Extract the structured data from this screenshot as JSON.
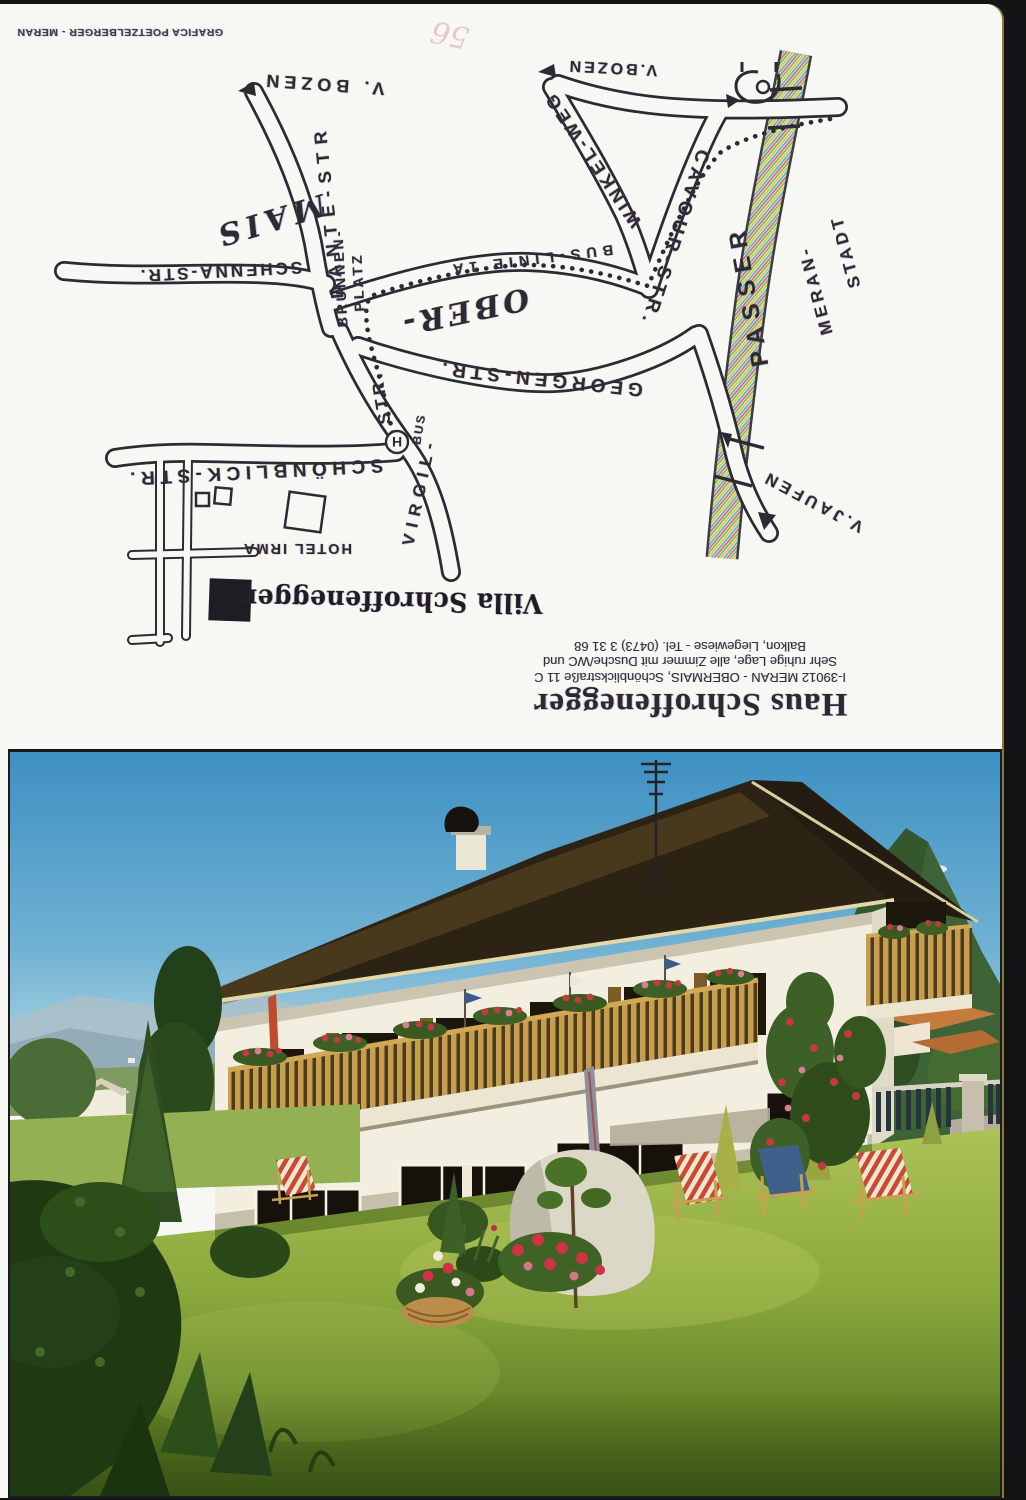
{
  "postcard": {
    "edge_credit": "GRAFICA POETZELBERGER - MERAN",
    "handwritten_mark": "56",
    "map": {
      "labels": {
        "v_bozen_left": "V. BOZEN",
        "v_bozen_right": "V.BOZEN",
        "dante_str": "DANTE-STR",
        "brunnen_1": "BRUNNEN-",
        "brunnen_2": "PLATZ",
        "mais": "MAIS",
        "schenna_str": "SCHENNA-STR.",
        "bus_linie": "BUS-LINIE 1A",
        "ober": "OBER-",
        "georgen_str": "GEORGEN-STR.",
        "winkel_weg": "WINKEL-WEG",
        "cavour_str": "CAVOUR-STR.",
        "passer": "PASSER",
        "meran_1": "MERAN-",
        "meran_2": "STADT",
        "v_jaufen": "V.JAUFEN",
        "virgil": "VIRGIL-",
        "virgil_str": "STR.",
        "bus": "BUS",
        "bus_stop_h": "H",
        "schoenblick_str": "SCHÖNBLICK-STR.",
        "hotel_irma": "HOTEL IRMA",
        "villa_marker": "Villa Schroffenegger"
      }
    },
    "title_block": {
      "name": "Haus Schroffenegger",
      "address": "I-39012 MERAN - OBERMAIS, Schönblickstraße 11 C",
      "line2": "Sehr ruhige Lage, alle Zimmer mit Dusche/WC und",
      "line3": "Balkon, Liegewiese - Tel. (0473) 3 31 68"
    }
  },
  "colors": {
    "paper": "#f7f7f3",
    "ink": "#2b2b33",
    "sky_top": "#3e90c2",
    "sky_horizon": "#cfe8ee",
    "mountain_green": "#3e6336",
    "lawn_light": "#acc257",
    "lawn_dark": "#46621a",
    "roof_brown": "#2c2315",
    "balcony_wood": "#c79d4e",
    "house_wall": "#f3efe0",
    "chair_red": "#c84a34",
    "chair_blue": "#40608c",
    "river_hatch": "#d96a74 #5ab6c9 #e3c23e #7bbb66"
  }
}
